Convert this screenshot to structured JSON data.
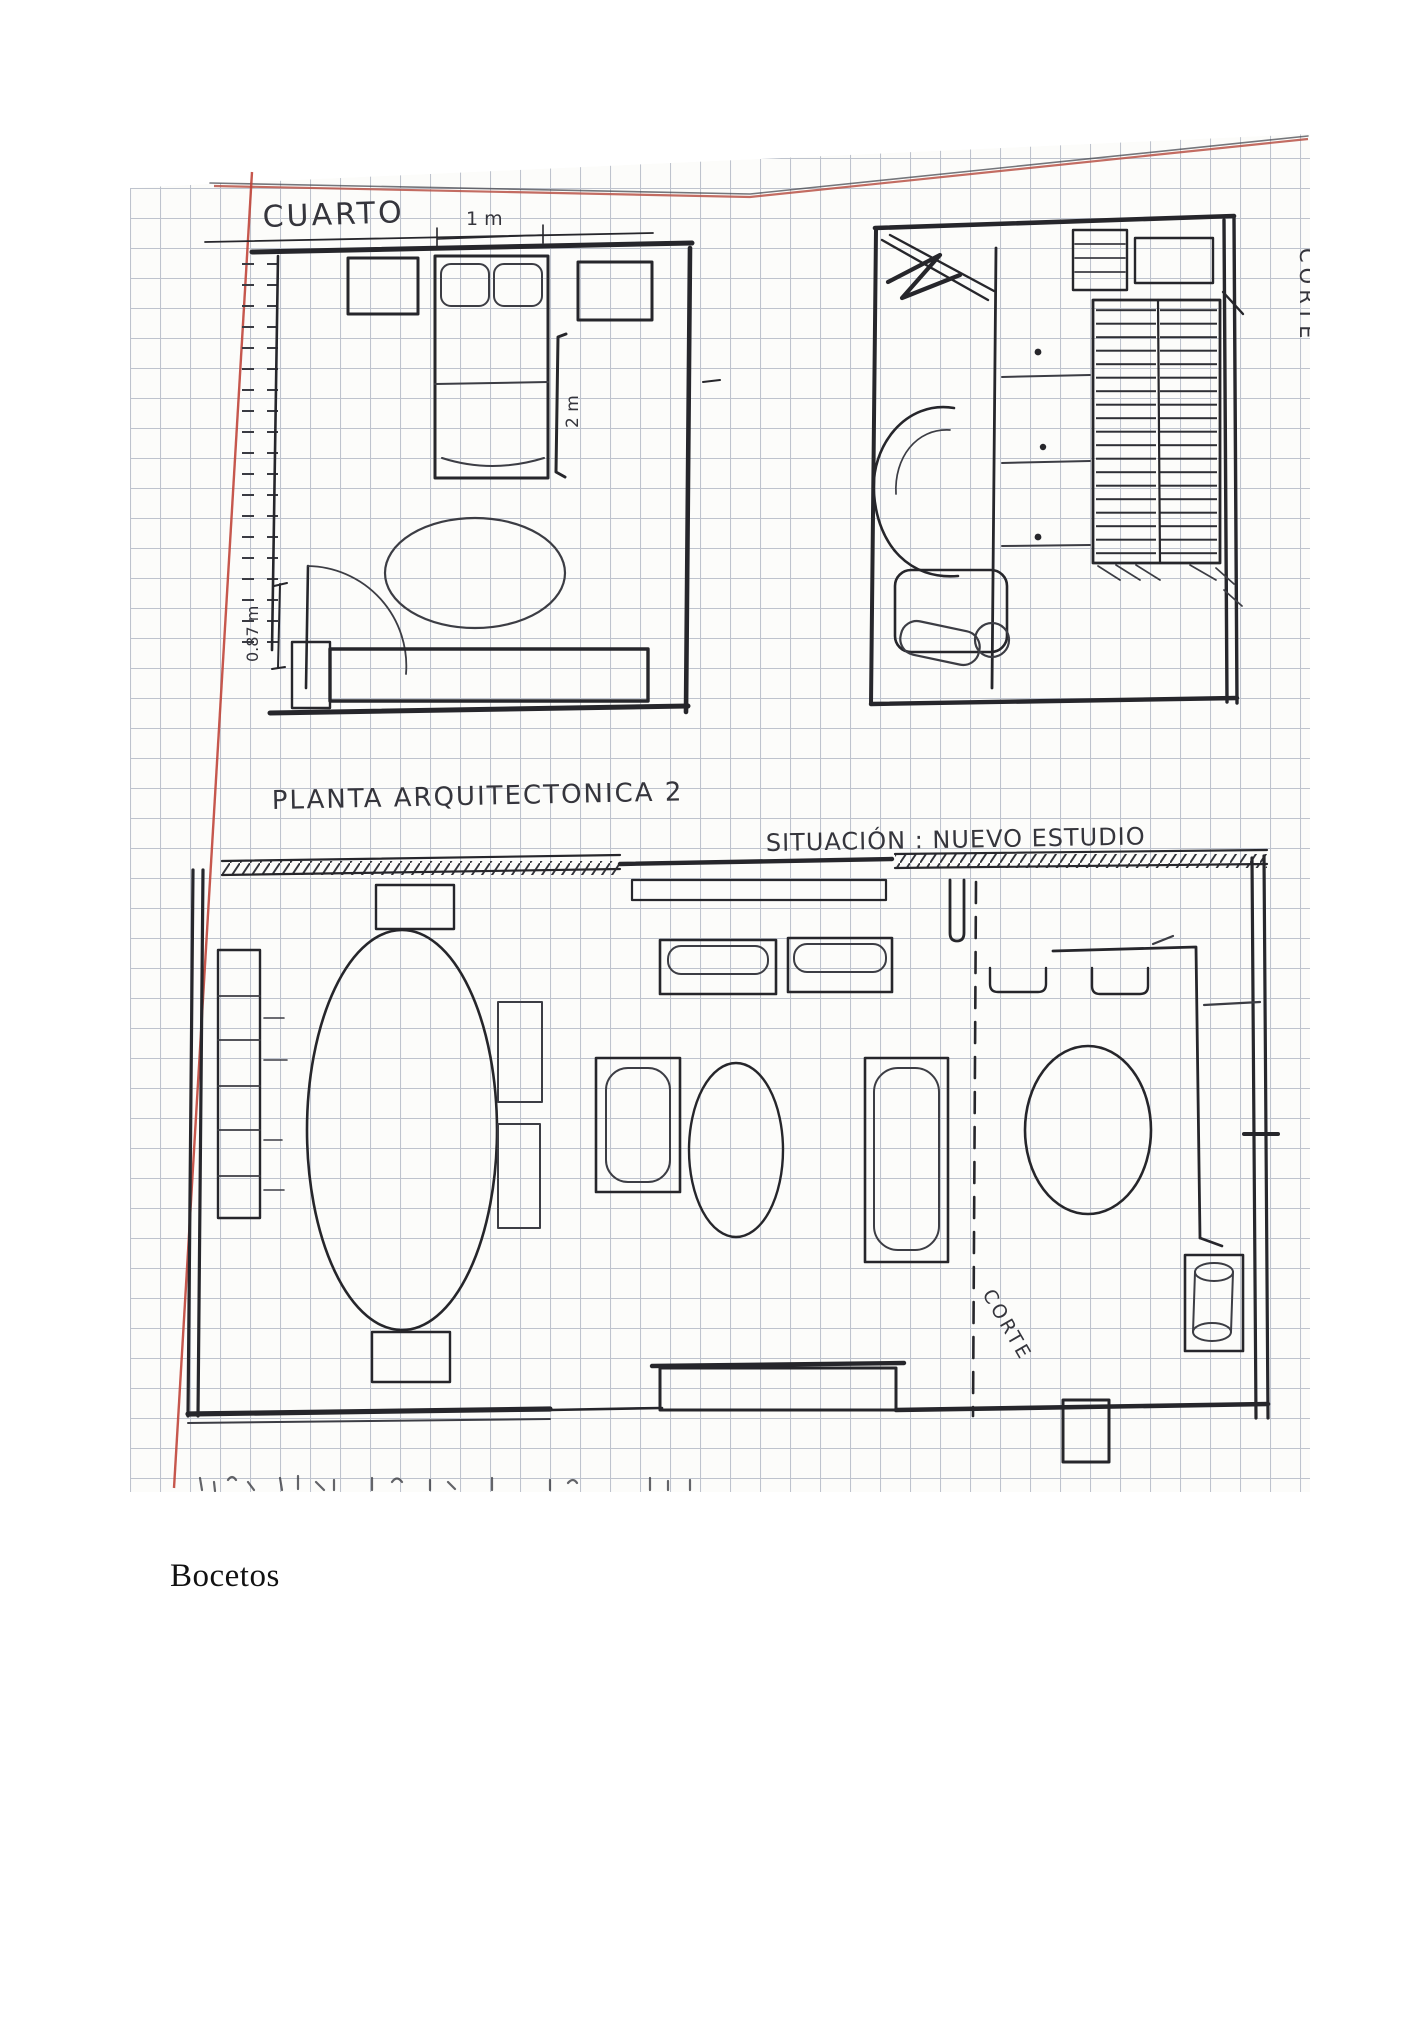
{
  "document": {
    "kind": "scanned notebook page with hand-drawn architectural floor plans",
    "caption": {
      "text": "Bocetos"
    }
  },
  "sketch": {
    "paper": {
      "grid_color": "#98a0b2",
      "margin_line_color": "#c0453a",
      "ink_color": "#26262b",
      "grid_cell_px": 30
    },
    "labels": {
      "room": "CUARTO",
      "dim_top": "1 m",
      "dim_side": "2 m",
      "dim_left": "0.87 m",
      "plan_title": "PLANTA ARQUITECTONICA 2",
      "situation_title": "SITUACIÓN : NUEVO ESTUDIO",
      "section_vertical": "CORTE",
      "section_line": "CORTE"
    }
  }
}
